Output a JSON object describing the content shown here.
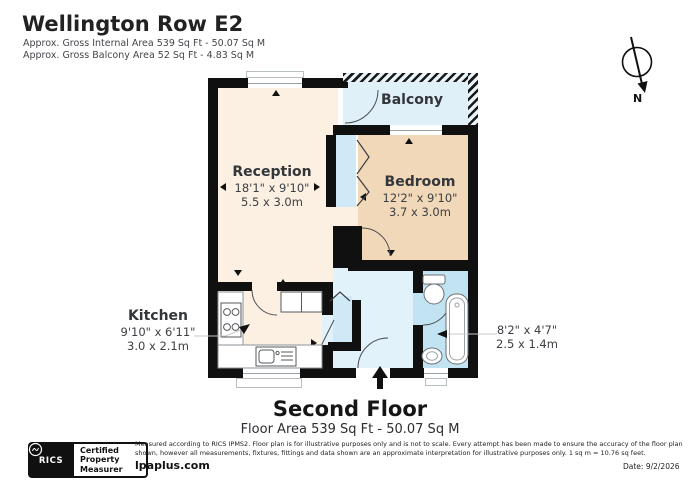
{
  "header": {
    "title": "Wellington Row E2",
    "subtitle1": "Approx. Gross Internal Area 539 Sq Ft - 50.07 Sq M",
    "subtitle2": "Approx. Gross Balcony Area 52 Sq Ft - 4.83 Sq M"
  },
  "compass": {
    "north_label": "N"
  },
  "rooms": {
    "reception": {
      "name": "Reception",
      "dims_ft": "18'1\" x 9'10\"",
      "dims_m": "5.5 x 3.0m"
    },
    "bedroom": {
      "name": "Bedroom",
      "dims_ft": "12'2\" x 9'10\"",
      "dims_m": "3.7 x 3.0m"
    },
    "balcony": {
      "name": "Balcony"
    },
    "kitchen": {
      "name": "Kitchen",
      "dims_ft": "9'10\" x 6'11\"",
      "dims_m": "3.0 x 2.1m"
    },
    "bathroom": {
      "dims_ft": "8'2\" x 4'7\"",
      "dims_m": "2.5 x 1.4m"
    }
  },
  "floor": {
    "name": "Second Floor",
    "area": "Floor Area 539 Sq Ft - 50.07 Sq M"
  },
  "footer": {
    "rics_label": "RICS",
    "badge_line1": "Certified",
    "badge_line2": "Property",
    "badge_line3": "Measurer",
    "disclaimer": "Measured according to RICS IPMS2. Floor plan is for illustrative purposes only and is not to scale. Every attempt has been made to ensure the accuracy of the floor plan shown, however all measurements, fixtures, fittings and data shown are an approximate interpretation for illustrative purposes only. 1 sq m = 10.76 sq feet.",
    "website": "lpaplus.com",
    "date": "Date: 9/2/2026"
  },
  "colors": {
    "wall": "#101010",
    "reception_kitchen": "#fbf0e2",
    "bedroom": "#f1d8b9",
    "balcony": "#dff0f8",
    "hallway": "#e2f2fa",
    "bathroom": "#c2e4f2",
    "closet": "#cfeaf6"
  }
}
